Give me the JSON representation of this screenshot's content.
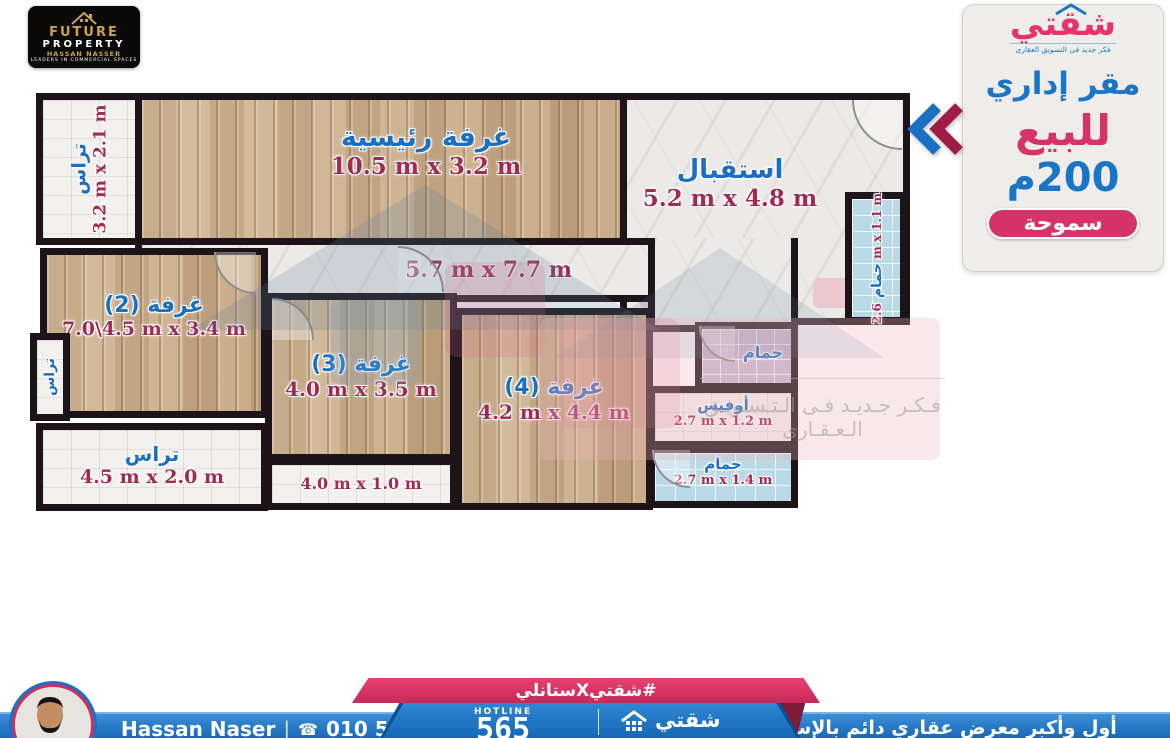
{
  "brand_card": {
    "line1": "FUTURE",
    "line2": "PROPERTY",
    "agent": "HASSAN NASSER",
    "tagline": "LEADERS IN COMMERCIAL SPACES"
  },
  "side_panel": {
    "logo_text": "شقتي",
    "logo_tagline": "فكر جديد فى التسويق العقارى",
    "property_type": "مقر إداري",
    "offer": "للبيع",
    "area": "200م",
    "location": "سموحة"
  },
  "rooms": {
    "terrace_top": {
      "label": "تراس",
      "dims": "3.2 m x 2.1 m"
    },
    "master": {
      "label": "غرفة رئيسية",
      "dims": "10.5 m x 3.2 m"
    },
    "reception": {
      "label": "استقبال",
      "dims": "5.2 m x 4.8 m"
    },
    "hall": {
      "dims": "5.7 m x 7.7 m"
    },
    "room2": {
      "label": "غرفة (2)",
      "dims": "7.0\\4.5 m x 3.4 m"
    },
    "room3": {
      "label": "غرفة (3)",
      "dims": "4.0 m x 3.5 m"
    },
    "room4": {
      "label": "غرفة (4)",
      "dims": "4.2 m x 4.4 m"
    },
    "bath_right": {
      "label": "حمام",
      "dims": "2.6 m x 1.1 m"
    },
    "bath_mid": {
      "label": "حمام"
    },
    "office": {
      "label": "أوفيس",
      "dims": "2.7 m x 1.2 m"
    },
    "bath_lower": {
      "label": "حمام",
      "dims": "2.7 m x 1.4 m"
    },
    "terrace_left": {
      "label": "تراس"
    },
    "terrace_bottom": {
      "label": "تراس",
      "dims": "4.5 m x 2.0 m"
    },
    "balcony_strip": {
      "dims": "4.0 m x 1.0 m"
    }
  },
  "watermark": {
    "text": "فـكـر جـديـد فـى الـتـسـويـق الـعـقـارى"
  },
  "footer": {
    "hashtag": "#شقتيXستانلي",
    "hotline_label": "HOTLINE",
    "hotline_number": "565",
    "logo_text": "شقتي",
    "agent_name": "Hassan Naser",
    "phone_icon": "☎",
    "phone": "010 504 073 18",
    "tagline": "أول وأكبر معرض عقاري دائم بالإسكندرية"
  },
  "colors": {
    "blue": "#1b75c6",
    "pink": "#d6336b",
    "maroon": "#a12a52",
    "gold": "#c9a24b"
  }
}
